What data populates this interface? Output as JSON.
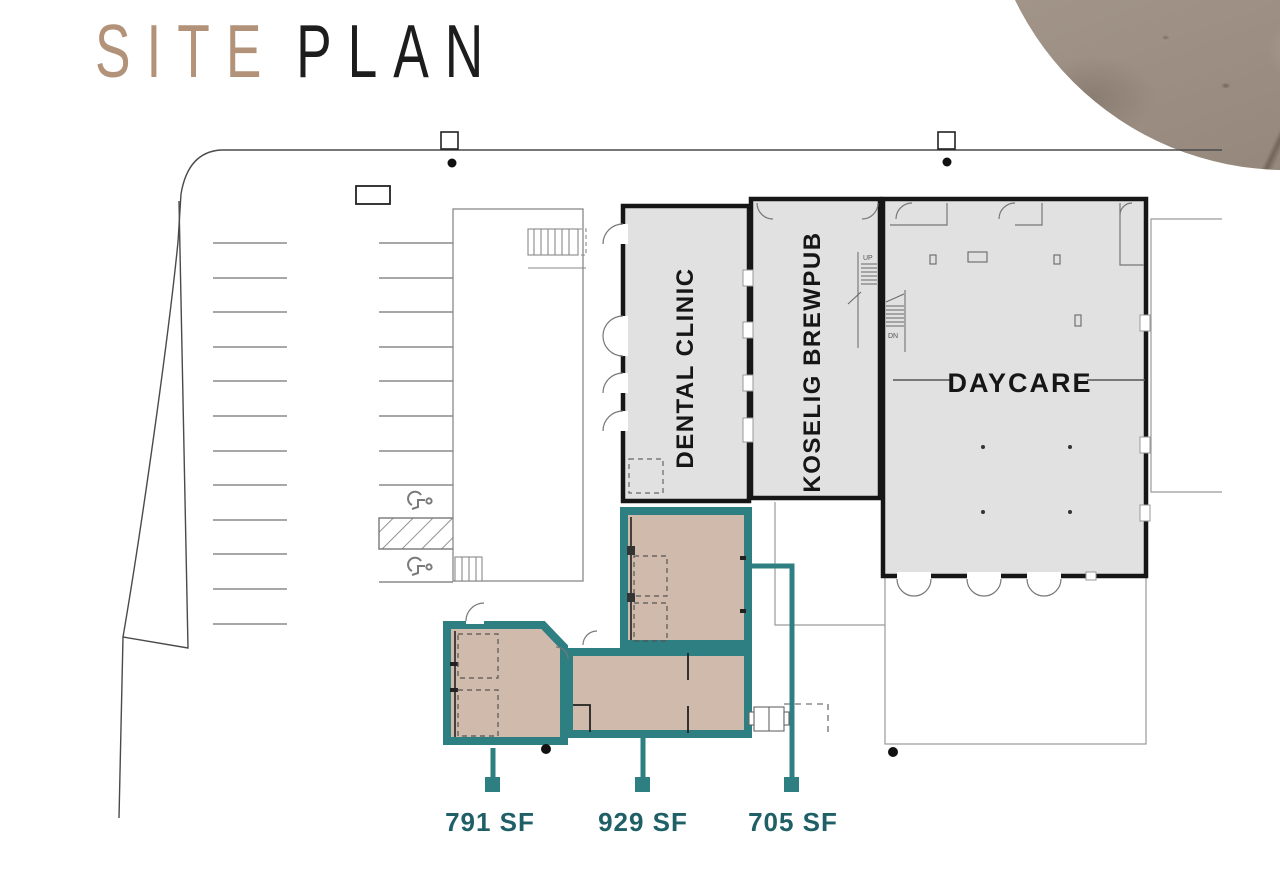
{
  "title": {
    "site": "SITE",
    "plan": "PLAN"
  },
  "buildings": {
    "dental": "DENTAL CLINIC",
    "brewpub": "KOSELIG BREWPUB",
    "daycare": "DAYCARE"
  },
  "stairs": {
    "up": "UP",
    "dn": "DN"
  },
  "available_units": [
    {
      "area": "791 SF"
    },
    {
      "area": "929 SF"
    },
    {
      "area": "705 SF"
    }
  ],
  "colors": {
    "accent_teal": "#2e7f82",
    "label_teal": "#1f5f66",
    "unit_fill": "#cfbaab",
    "building_fill": "#e1e1e1",
    "title_tan": "#b29278"
  }
}
